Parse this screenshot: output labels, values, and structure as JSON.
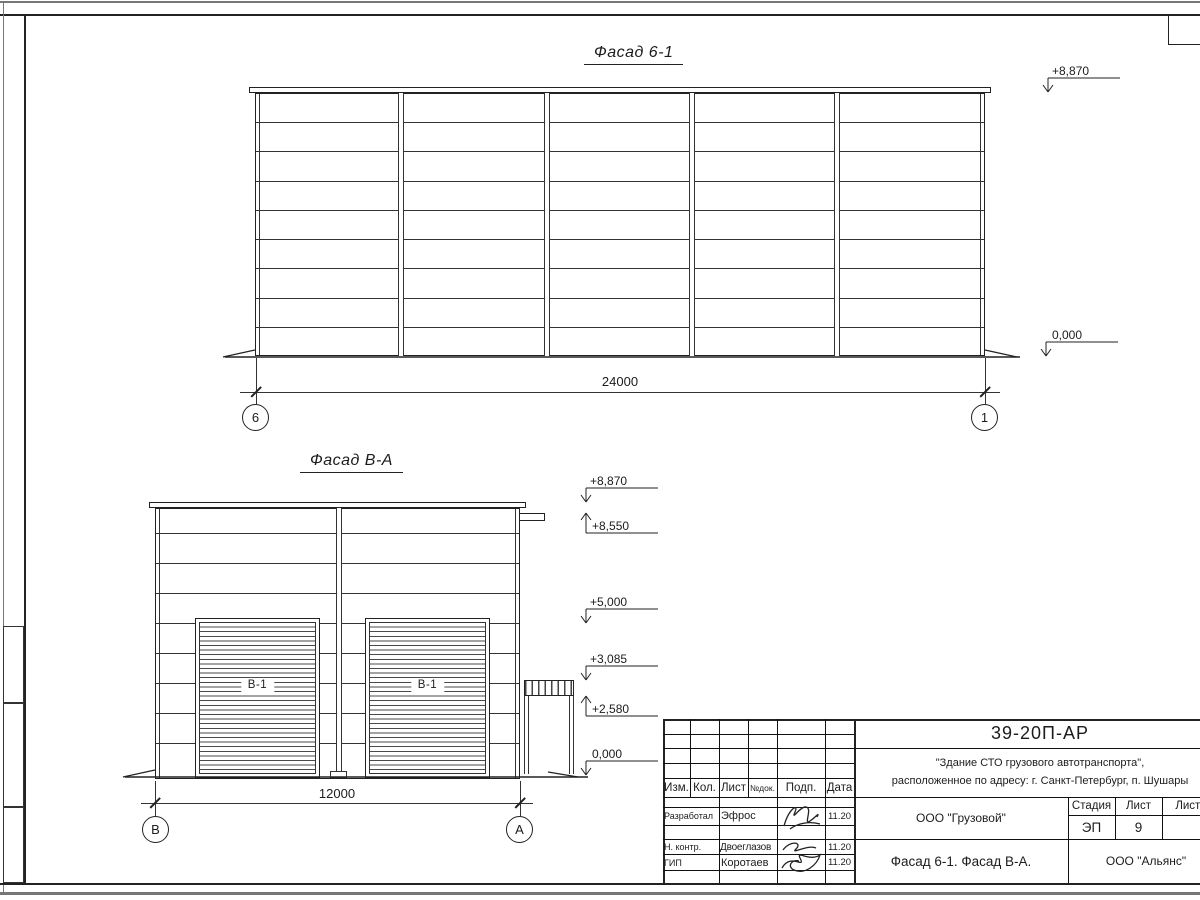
{
  "facade_top": {
    "title": "Фасад 6-1",
    "level_top": "+8,870",
    "level_zero": "0,000",
    "dimension": "24000",
    "axis_left": "6",
    "axis_right": "1"
  },
  "facade_side": {
    "title": "Фасад В-А",
    "dimension": "12000",
    "axis_left": "В",
    "axis_right": "А",
    "door1_label": "В-1",
    "door2_label": "В-1",
    "levels": {
      "l8870": "+8,870",
      "l8550": "+8,550",
      "l5000": "+5,000",
      "l3085": "+3,085",
      "l2580": "+2,580",
      "l0": "0,000"
    }
  },
  "title_block": {
    "code": "39-20П-АР",
    "project_line1": "\"Здание СТО грузового автотранспорта\",",
    "project_line2": "расположенное по адресу: г. Санкт-Петербург, п. Шушары",
    "client": "ООО \"Грузовой\"",
    "sheet_title": "Фасад 6-1. Фасад В-А.",
    "company": "ООО \"Альянс\"",
    "stage_label": "Стадия",
    "sheet_label": "Лист",
    "sheets_label": "Листов",
    "stage_value": "ЭП",
    "sheet_value": "9",
    "header": [
      "Изм.",
      "Кол.",
      "Лист",
      "№док.",
      "Подп.",
      "Дата"
    ],
    "rows": [
      {
        "role": "Разработал",
        "name": "Эфрос",
        "date": "11.20"
      },
      {
        "role": "Н. контр.",
        "name": "Двоеглазов",
        "date": "11.20"
      },
      {
        "role": "ГИП",
        "name": "Коротаев",
        "date": "11.20"
      }
    ]
  }
}
